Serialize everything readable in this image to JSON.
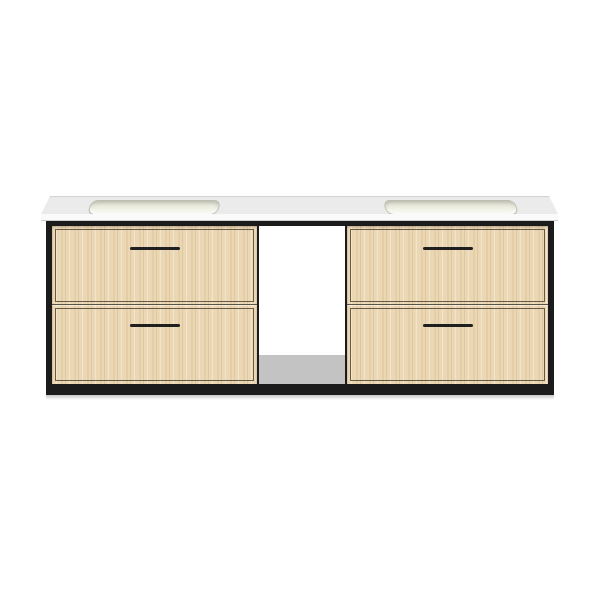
{
  "image": {
    "description": "Product photo of a wall-mounted double-sink bathroom vanity on a plain white background",
    "text_content": "none"
  },
  "product": {
    "kind": "wall-mounted double bathroom vanity",
    "countertop": {
      "look": "white solid-surface slab with two integrated rectangular sink basins",
      "sink_count": 2
    },
    "frame": {
      "look": "thin matte black metal frame around cabinet"
    },
    "drawer_units": [
      {
        "position": "left",
        "drawer_count": 2,
        "handle": "black horizontal bar pull, centered"
      },
      {
        "position": "right",
        "drawer_count": 2,
        "handle": "black horizontal bar pull, centered"
      }
    ],
    "center_section": "open niche with gray shelf floor",
    "wood_finish": "light oak with fine vertical grain"
  },
  "colors": {
    "background": "#ffffff",
    "counter_top": "#ebebeb",
    "counter_edge": "#fafafa",
    "counter_edge_line": "#cfcfcf",
    "frame_black": "#1b1b1b",
    "wood_base": "#ebd7b3",
    "drawer_outline": "rgba(80,68,52,0.85)",
    "divider_line": "#5a5244",
    "handle_black": "#1f1f1f",
    "sink_rim": "#bcbdb0",
    "sink_fill": "#edeee2",
    "shelf_floor": "#c3c3c3"
  }
}
